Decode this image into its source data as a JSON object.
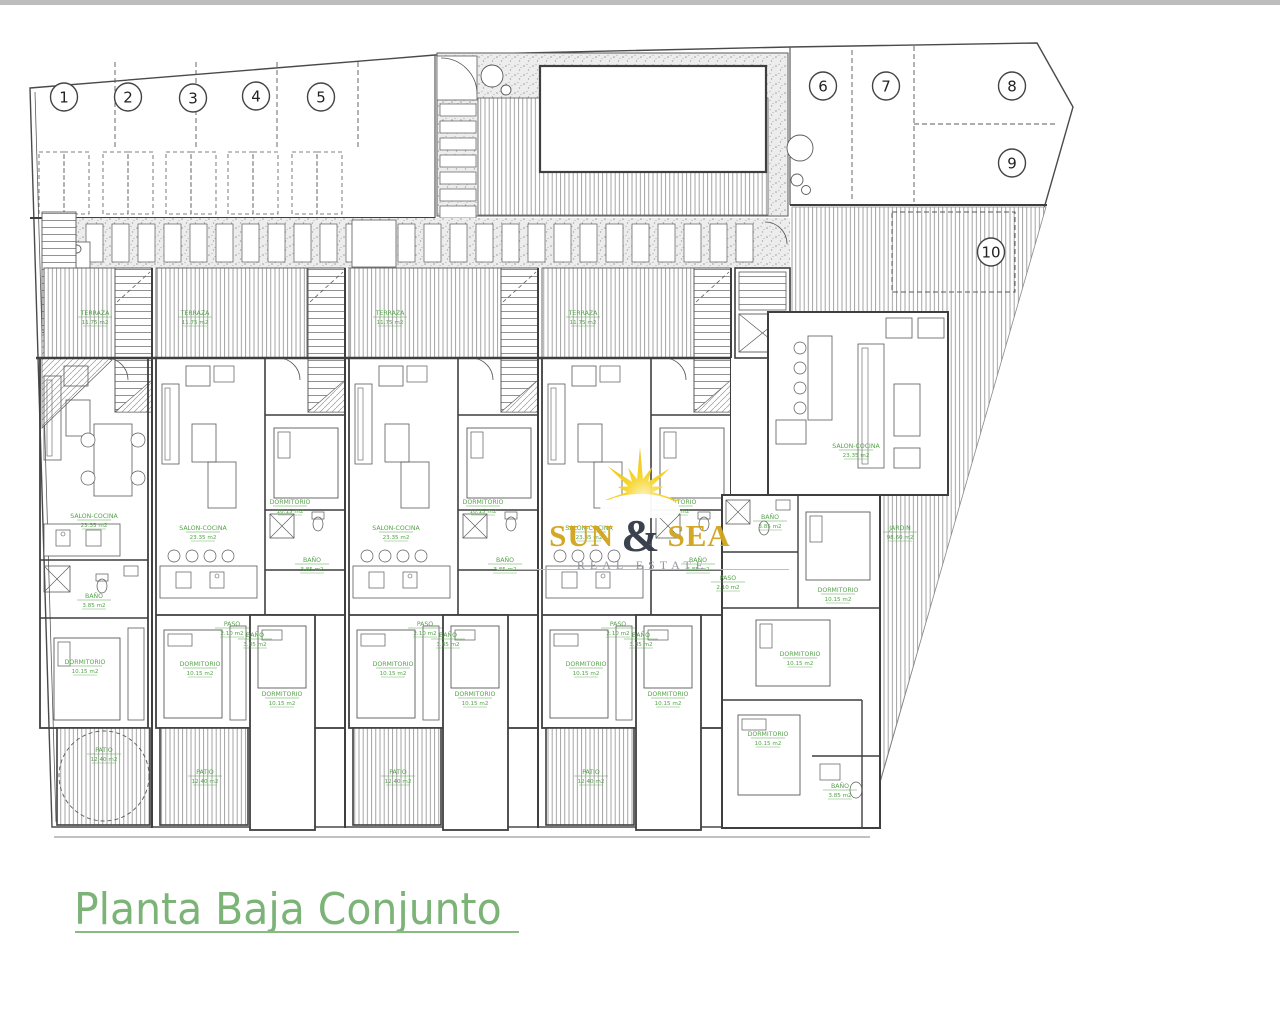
{
  "page": {
    "background": "#ffffff",
    "top_strip_color": "#bdbdbd"
  },
  "title": {
    "text": "Planta Baja Conjunto",
    "color": "#7cb478"
  },
  "watermark": {
    "brand": {
      "word1": "SUN",
      "amp": "&",
      "word2": "SEA"
    },
    "subtitle": "REAL ESTATE",
    "colors": {
      "gold": "#d2a51e",
      "amp": "#343b47",
      "subtitle": "#8f949c",
      "sun_core": "#f6d527"
    }
  },
  "plots": {
    "numbers": [
      "1",
      "2",
      "3",
      "4",
      "5",
      "6",
      "7",
      "8",
      "9",
      "10"
    ]
  },
  "rooms": {
    "terraza": {
      "name": "TERRAZA",
      "area": "11.75 m2"
    },
    "salon": {
      "name": "SALON-COCINA",
      "area": "23.35 m2"
    },
    "dormitorio": {
      "name": "DORMITORIO",
      "area": "10.15 m2"
    },
    "bano": {
      "name": "BAÑO",
      "area": "3.85 m2"
    },
    "paso": {
      "name": "PASO",
      "area": "2.10 m2"
    },
    "patio": {
      "name": "PATIO",
      "area": "12.40 m2"
    },
    "jardin": {
      "name": "JARDIN",
      "area": "98.60 m2"
    }
  },
  "plan": {
    "wall_color": "#3f3f3f",
    "line_color": "#5a5a5a",
    "label_color": "#55a24a"
  }
}
